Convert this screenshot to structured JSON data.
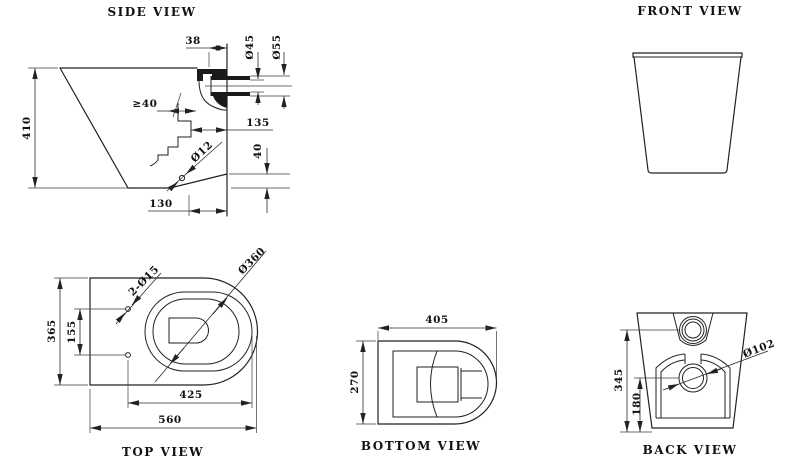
{
  "drawing": {
    "kind": "technical-drawing",
    "subject": "back-to-wall toilet pan dimensions",
    "colors": {
      "line": "#222222",
      "text": "#111111",
      "background": "#ffffff"
    },
    "views": {
      "side": {
        "title": "SIDE VIEW",
        "dims": {
          "spud_offset": "38",
          "spud_bore": "Ø45",
          "spud_outer": "Ø55",
          "overall_height": "410",
          "seal_depth": "≥40",
          "trap_to_wall": "135",
          "fixing_hole": "Ø12",
          "outlet_height": "40",
          "hole_to_wall": "130"
        }
      },
      "front": {
        "title": "FRONT VIEW"
      },
      "top": {
        "title": "TOP VIEW",
        "dims": {
          "overall_width": "365",
          "hole_spacing": "155",
          "fixing_holes": "2-Ø15",
          "bowl_diameter": "Ø360",
          "holes_to_front": "425",
          "overall_length": "560"
        }
      },
      "bottom": {
        "title": "BOTTOM VIEW",
        "dims": {
          "base_length": "405",
          "base_width": "270"
        }
      },
      "back": {
        "title": "BACK VIEW",
        "dims": {
          "inlet_height": "345",
          "outlet_center_height": "180",
          "outlet_diameter": "Ø102"
        }
      }
    }
  }
}
